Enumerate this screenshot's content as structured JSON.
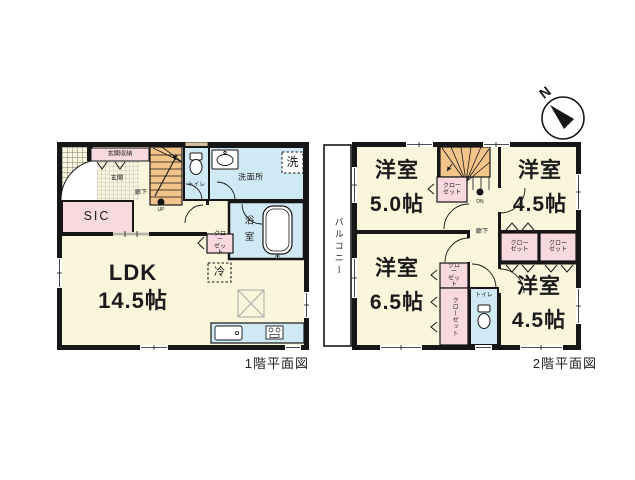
{
  "compass": {
    "north_label": "N"
  },
  "floor1": {
    "caption": "1階平面図",
    "labels": {
      "entrance_storage": "玄関収納",
      "entrance": "玄関",
      "sic": "SIC",
      "hallway": "廊下",
      "stairs_up": "UP",
      "toilet": "トイレ",
      "washroom": "洗面所",
      "laundry": "洗",
      "bathroom": "浴室",
      "closet": "クロー\nゼット",
      "fridge": "冷",
      "ldk_name": "LDK",
      "ldk_size": "14.5帖"
    }
  },
  "floor2": {
    "caption": "2階平面図",
    "labels": {
      "balcony": "バルコニー",
      "room_tl_name": "洋室",
      "room_tl_size": "5.0帖",
      "room_tr_name": "洋室",
      "room_tr_size": "4.5帖",
      "room_bl_name": "洋室",
      "room_bl_size": "6.5帖",
      "room_br_name": "洋室",
      "room_br_size": "4.5帖",
      "hallway": "廊下",
      "stairs_down": "DN",
      "toilet": "トイレ",
      "closet": "クロー\nゼット",
      "closet_vertical": "クローゼット"
    }
  },
  "colors": {
    "room_cream": "#faf6dc",
    "water_blue": "#cfe9f5",
    "closet_pink": "#f9d9e0",
    "stairs_orange": "#f3c489",
    "window_tan": "#cfc09b",
    "wall_black": "#161616"
  }
}
